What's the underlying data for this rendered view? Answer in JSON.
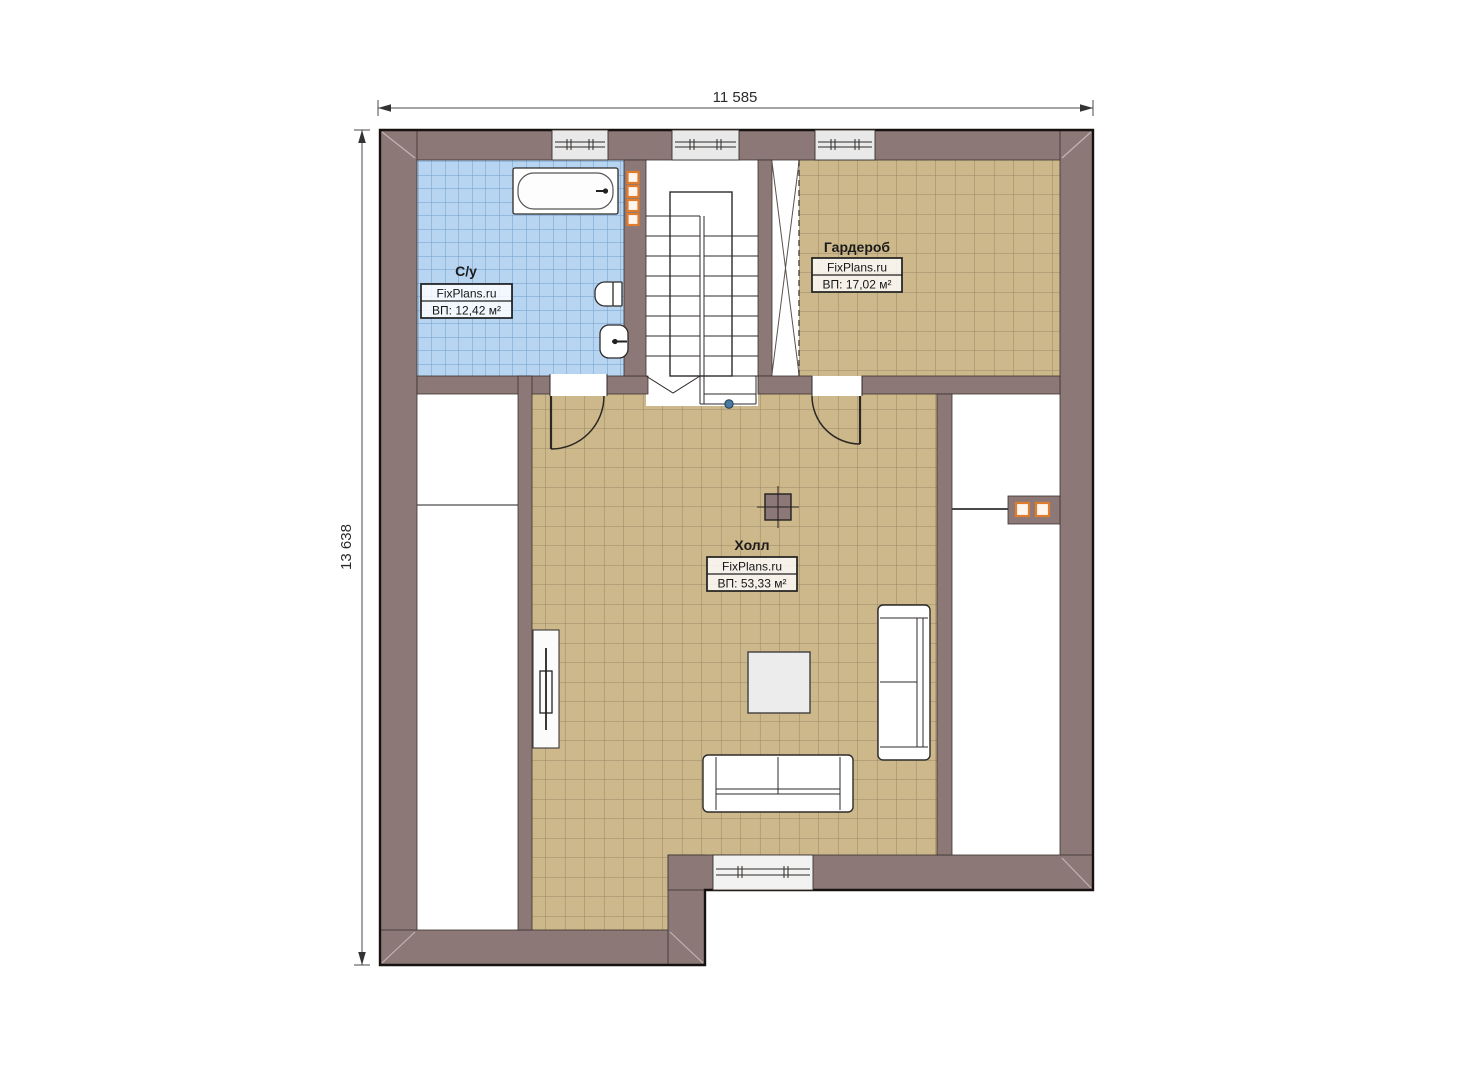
{
  "plan": {
    "type": "floor-plan",
    "dimensions": {
      "top_label": "11 585",
      "left_label": "13 638"
    },
    "rooms": [
      {
        "key": "bathroom",
        "name": "С/у",
        "brand": "FixPlans.ru",
        "area": "ВП: 12,42 м²"
      },
      {
        "key": "wardrobe",
        "name": "Гардероб",
        "brand": "FixPlans.ru",
        "area": "ВП: 17,02 м²"
      },
      {
        "key": "hall",
        "name": "Холл",
        "brand": "FixPlans.ru",
        "area": "ВП: 53,33 м²"
      }
    ],
    "colors": {
      "wall": "#8c7977",
      "wall_edge": "#3a322f",
      "outline": "#17120f",
      "bathroom_tile": "#b7d5f1",
      "bathroom_tile_line": "#6f9fcc",
      "floor_tile": "#cdb88c",
      "floor_tile_line": "#9c8a66",
      "window_fill": "#e9e9e9",
      "flue_accent": "#e07c2e",
      "stair_node": "#4a7aa0",
      "dimension_text": "#2b2b2b"
    }
  }
}
